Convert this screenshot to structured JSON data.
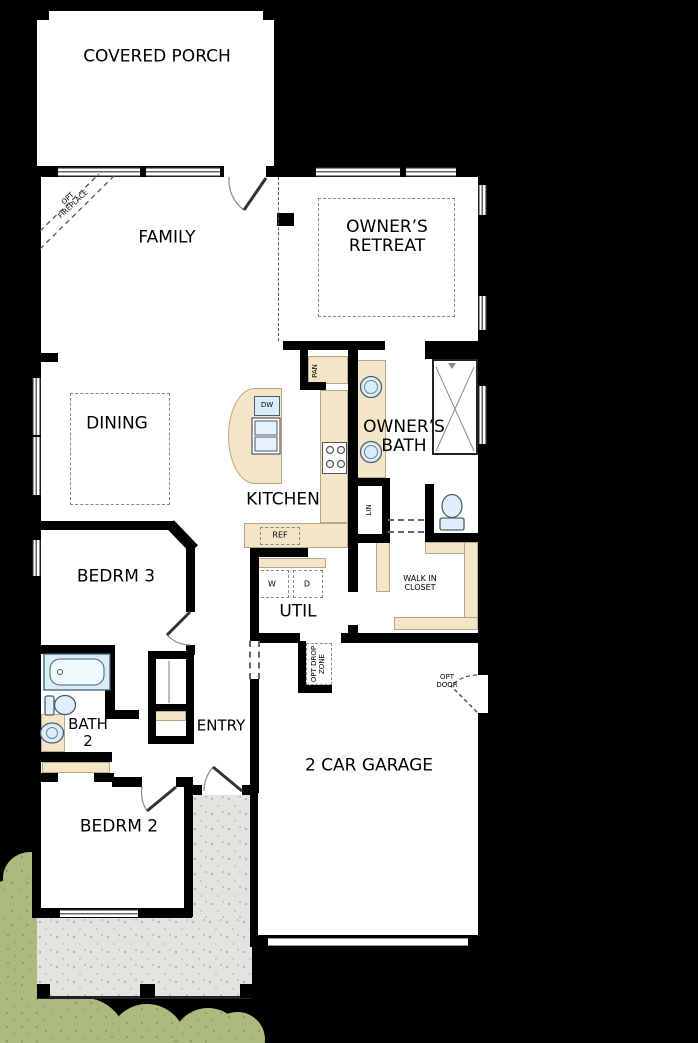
{
  "plan_type": "floor-plan",
  "labels": {
    "covered_porch": "COVERED PORCH",
    "family": "FAMILY",
    "owners_retreat": "OWNER’S RETREAT",
    "dining": "DINING",
    "kitchen": "KITCHEN",
    "owners_bath": "OWNER’S BATH",
    "bedrm3": "BEDRM 3",
    "util": "UTIL",
    "walk_in_closet": "WALK IN CLOSET",
    "bath2": "BATH 2",
    "entry": "ENTRY",
    "bedrm2": "BEDRM 2",
    "garage": "2 CAR GARAGE"
  },
  "fixtures": {
    "dishwasher": "DW",
    "refrigerator": "REF",
    "pantry": "PAN",
    "linen": "LIN",
    "washer": "W",
    "dryer": "D"
  },
  "options": {
    "fireplace": "OPT FIREPLACE",
    "drop_zone": "OPT DROP ZONE",
    "door": "OPT DOOR"
  },
  "colors": {
    "wall": "#000000",
    "floor": "#ffffff",
    "counter": "#f3e5c6",
    "fixture_blue": "#d9ecf8",
    "concrete": "#e3e3df",
    "landscape_green": "#abba7f"
  }
}
